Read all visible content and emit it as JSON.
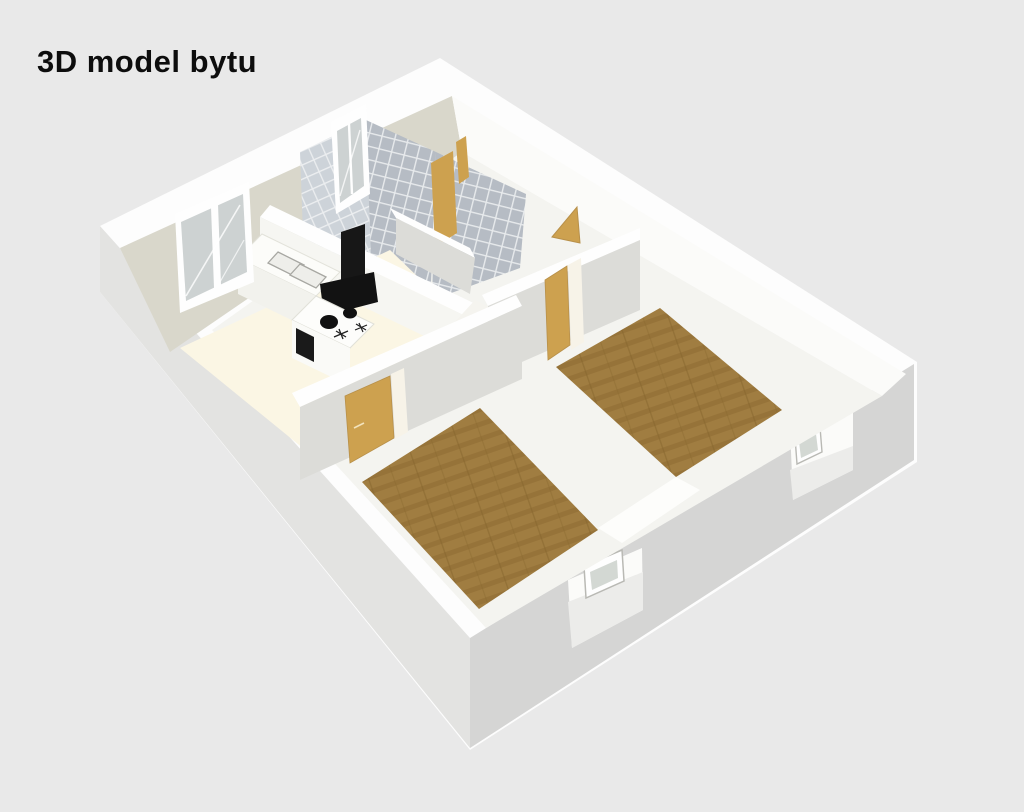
{
  "title": "3D model bytu",
  "scene": {
    "type": "3d-apartment-floorplan-render",
    "colors": {
      "background": "#e9e9e9",
      "title_color": "#0d0d0d",
      "wall_top": "#fdfdfd",
      "facade_left": "#e3e3e1",
      "facade_right": "#d5d5d4",
      "back_wall": "#d9d7cb",
      "interior_wall_shaded": "#dcdcd8",
      "interior_wall_lit": "#fbfbf9",
      "floor_base": "#f4f4f0",
      "floor_kitchen": "#fbf6e4",
      "floor_wood": "#a07d41",
      "floor_wood_dark": "#8d6c33",
      "door": "#cda14f",
      "tile_light": "#cdd3d9",
      "tile_dark": "#b6bcc4",
      "grout": "#e7eaec",
      "appliance_black": "#171717",
      "glass": "#cdd2d2"
    },
    "objects": [
      "kitchen-window",
      "bathroom-window",
      "kitchen-counter",
      "kitchen-sink",
      "stove",
      "cooker-hood",
      "bathroom-door",
      "wc-door",
      "entry-door",
      "bedroom-1-door",
      "bedroom-2-door",
      "bedroom-1-wood-floor",
      "bedroom-2-wood-floor",
      "facade-window-opening-1",
      "facade-window-opening-2"
    ]
  }
}
